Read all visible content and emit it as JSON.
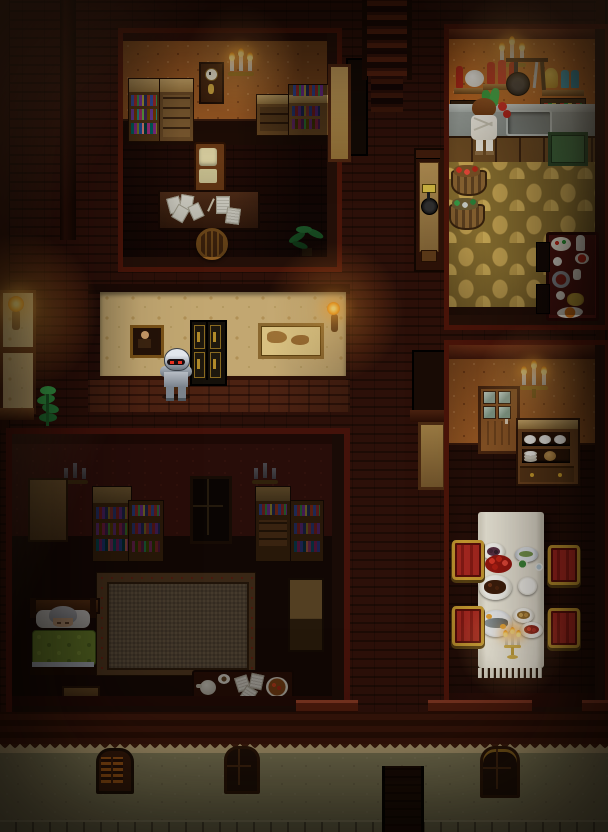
{
  "scene": {
    "label": "Top-down pixel-art RPG mansion interior at night",
    "width": 608,
    "height": 832
  },
  "palette": {
    "outer_brick": "#2c1009",
    "wood_dark": "#1e0c06",
    "study_wallpaper": "#9c5a24",
    "kitchen_wallpaper": "#aa5f2b",
    "dining_wallpaper": "#a05627",
    "hall_wallpaper": "#c2a771",
    "bedroom_wallpaper": "#41150e",
    "kitchen_floor": "#c6a452",
    "counter_grey": "#a9afa9",
    "tablecloth": "#efeadb",
    "chair_red": "#a82820",
    "chair_gold": "#c89a30",
    "blanket_green": "#7a9a33",
    "flame_orange": "#ffaa24",
    "stucco": "#8e8963",
    "roof": "#3f170b"
  },
  "rooms": {
    "study": {
      "label": "Study with bookshelves and writing desk"
    },
    "kitchen": {
      "label": "Kitchen with stone floor"
    },
    "hallway": {
      "label": "Torch-lit hallway"
    },
    "bedroom": {
      "label": "Dark bedroom"
    },
    "dining": {
      "label": "Dining room with set table"
    },
    "exterior": {
      "label": "Street-facing stucco wall"
    }
  },
  "characters": {
    "knight": {
      "label": "Knight in plate armor with red glowing eyes",
      "pose": "standing in hallway facing viewer"
    },
    "cook": {
      "label": "Cook in white apron with brown hair",
      "pose": "working at kitchen counter over vegetables"
    },
    "sleeper": {
      "label": "Grey-haired person asleep under green blanket",
      "pose": "lying in bed"
    }
  },
  "study": {
    "bookshelf": "Bookshelf with colored books",
    "cabinet": "Drawer cabinet",
    "clock": "Wall clock",
    "sconce": "Three-candle wall sconce (lit)",
    "desk_books": "Side desks stacked with books",
    "chair": "Cushioned desk chair",
    "desk": "Writing desk strewn with papers",
    "round_chair": "Round-back wooden chair",
    "plant": "Potted palm plant",
    "stairs": "Staircase leading up"
  },
  "kitchen": {
    "sconce": "Three-candle wall sconce (lit)",
    "shelf_left": "Shelf with red bottle and cheese wheel",
    "shelf_mid": "Shelf with three red bottles",
    "shelf_right": "Shelf with flour sack and blue bottles",
    "rack": "Hanging frying pan and utensils",
    "spices": "Spice racks with jars",
    "counter": "Stone counter with sink",
    "green_cabinet": "Green cupboard",
    "basket_apples": "Basket of red apples",
    "basket_greens": "Basket of vegetables",
    "side_table": "Side table with bowls, jugs and dishes",
    "pan_sign": "Wall panel with plaque and hanging pan"
  },
  "hallway": {
    "door": "Dark double door with gold panels",
    "portrait": "Framed portrait painting",
    "map": "Framed map picture",
    "torch_left": "Lit wall torch",
    "torch_right": "Lit wall torch",
    "plant": "Green plant"
  },
  "bedroom": {
    "sconce_left": "Unlit candle sconce",
    "sconce_right": "Unlit candle sconce",
    "window": "Dark latticed window",
    "wardrobe_left": "Wardrobe",
    "wardrobe_right": "Tall cabinet",
    "shelves": "Bookshelves with books",
    "rug": "Large patterned rug",
    "bed": "Bed with green blanket",
    "mat": "Wooden step mat",
    "tray": "Low table with teapot, papers and a bowl of food"
  },
  "dining": {
    "door": "Glass-paned wooden door",
    "sconce": "Three-candle wall sconce (lit)",
    "hutch": "Hutch with plates and bread",
    "table": "Long table with white cloth",
    "chairs": "Four red-and-gold chairs",
    "dishes": [
      {
        "label": "plate of dark berries"
      },
      {
        "label": "fish appetizer platter"
      },
      {
        "label": "side salad"
      },
      {
        "label": "teacup"
      },
      {
        "label": "pile of strawberries"
      },
      {
        "label": "roast platter"
      },
      {
        "label": "empty plate"
      },
      {
        "label": "grilled fish platter"
      },
      {
        "label": "plate of potatoes"
      },
      {
        "label": "berry dessert plate"
      },
      {
        "label": "lit gold candelabra"
      }
    ]
  },
  "exterior": {
    "window_shuttered": "Arched window with orange shutters",
    "window_dark_1": "Dark arched window",
    "window_dark_2": "Dark arched window with gold arch",
    "doorway": "Dark entry passage",
    "ledge": "Stone footing",
    "trim": "Triangle dentil trim"
  }
}
